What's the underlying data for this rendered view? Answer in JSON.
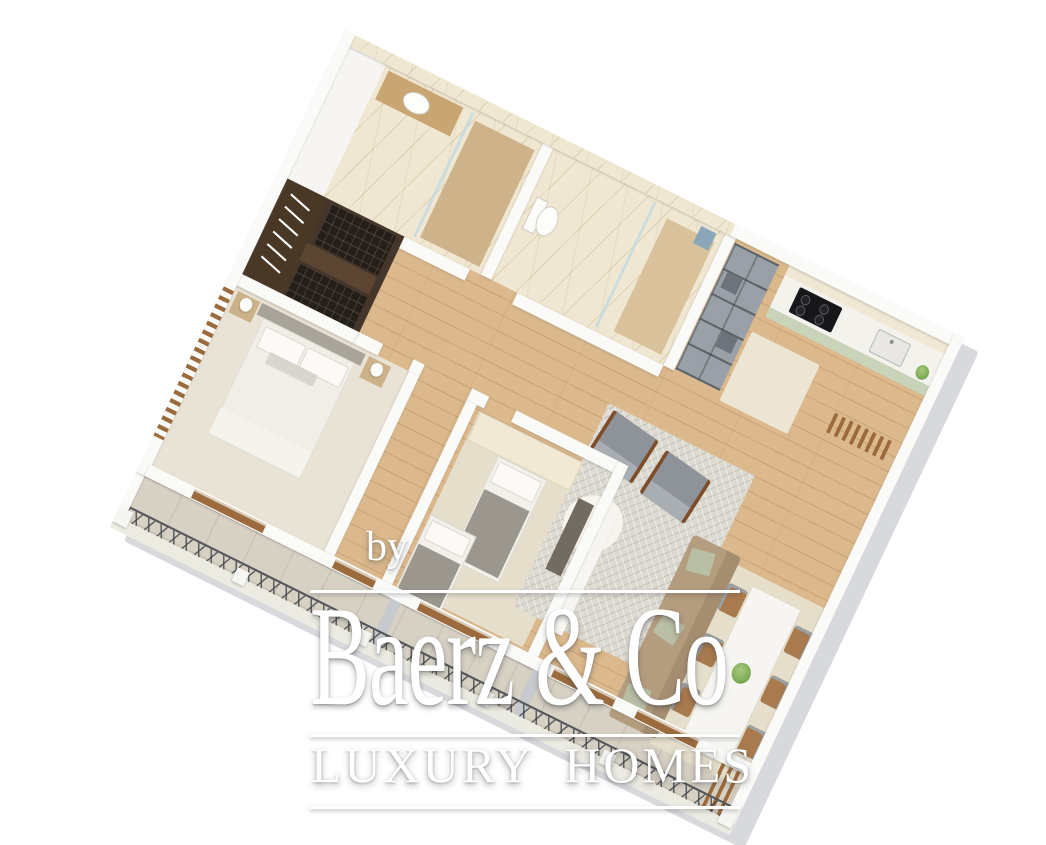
{
  "watermark": {
    "prefix": "by",
    "brand": "Baerz & Co",
    "tagline": "LUXURY HOMES"
  },
  "palette": {
    "background": "#ffffff",
    "watermark_text": "#ffffff",
    "wood_floor": "#dcb98c",
    "marble_floor": "#efe7d2",
    "bedroom_carpet": "#e9e3d5",
    "terrace_stone": "#d7d1c4",
    "wall": "#fafaf8",
    "building_side": "#d8d9dd",
    "closet_wood": "#46352a",
    "kitchen_cabinet_sage": "#c9d3ba",
    "kitchen_cooktop": "#17171a",
    "sofa_tan": "#b49c7e",
    "armchair_gray": "#8d9399",
    "dining_chair_wood": "#a97a4e",
    "door_frame_wood": "#9c6b3d",
    "railing_metal": "#54575c",
    "rug_gray": "#dcd9d0",
    "rug_beige": "#e5decb",
    "plant_green": "#7fae57"
  },
  "scene": {
    "type": "3d-isometric-floor-plan",
    "rooms": [
      {
        "name": "bathroom-1",
        "features": [
          "marble-floor",
          "glass-shower",
          "wood-vanity",
          "mirror"
        ]
      },
      {
        "name": "bathroom-2",
        "features": [
          "marble-floor",
          "toilet",
          "glass-shower",
          "shower-head"
        ]
      },
      {
        "name": "walk-in-closet",
        "features": [
          "dark-wood-wardrobe",
          "hanging-clothes",
          "tufted-mats"
        ]
      },
      {
        "name": "master-bedroom",
        "features": [
          "double-bed",
          "headboard",
          "nightstands",
          "lamps",
          "wall-art",
          "carpet"
        ]
      },
      {
        "name": "second-bedroom",
        "features": [
          "two-single-beds",
          "wardrobe",
          "desk",
          "rug"
        ]
      },
      {
        "name": "living-dining-room",
        "features": [
          "sofa",
          "two-armchairs",
          "gray-rug",
          "dining-table",
          "six-chairs",
          "plant-centerpiece",
          "tv-console"
        ]
      },
      {
        "name": "kitchen",
        "features": [
          "cooktop",
          "sink",
          "sage-cabinets",
          "plant"
        ]
      },
      {
        "name": "entry",
        "features": [
          "shelving-unit",
          "doormat"
        ]
      },
      {
        "name": "terrace",
        "features": [
          "stone-floor",
          "x-lattice-railing",
          "pillars",
          "wood-louvers",
          "glass-doors"
        ]
      }
    ]
  }
}
